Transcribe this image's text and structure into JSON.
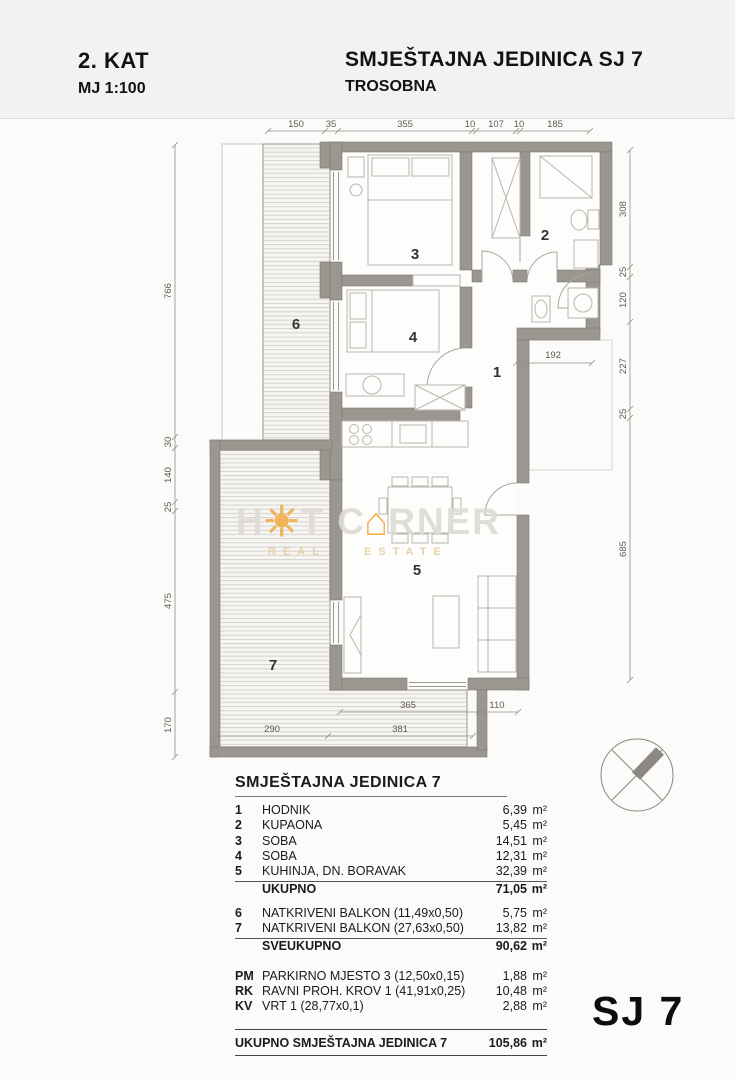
{
  "header": {
    "floor": "2. KAT",
    "scale": "MJ 1:100",
    "title": "SMJEŠTAJNA JEDINICA SJ 7",
    "subtitle": "TROSOBNA"
  },
  "plan": {
    "dims_top": [
      "150",
      "35",
      "355",
      "10",
      "107",
      "10",
      "185"
    ],
    "dims_left": [
      "766",
      "30",
      "140",
      "25",
      "475",
      "170"
    ],
    "dims_right": [
      "308",
      "25",
      "120",
      "227",
      "25",
      "685"
    ],
    "dims_bottom_row1": [
      "365",
      "110"
    ],
    "dims_bottom_row2": [
      "290",
      "381"
    ],
    "dim_interior": "192",
    "room_labels": [
      "1",
      "2",
      "3",
      "4",
      "5",
      "6",
      "7"
    ]
  },
  "watermark": {
    "part1": "H",
    "sun": "☀",
    "part2": "T C",
    "house": "⌂",
    "part3": "RNER",
    "tagline_left": "REAL",
    "tagline_right": "ESTATE"
  },
  "legend": {
    "title": "SMJEŠTAJNA JEDINICA 7",
    "rows": [
      {
        "no": "1",
        "name": "HODNIK",
        "area": "6,39",
        "unit": "m²"
      },
      {
        "no": "2",
        "name": "KUPAONA",
        "area": "5,45",
        "unit": "m²"
      },
      {
        "no": "3",
        "name": "SOBA",
        "area": "14,51",
        "unit": "m²"
      },
      {
        "no": "4",
        "name": "SOBA",
        "area": "12,31",
        "unit": "m²"
      },
      {
        "no": "5",
        "name": "KUHINJA, DN. BORAVAK",
        "area": "32,39",
        "unit": "m²"
      }
    ],
    "total1": {
      "label": "UKUPNO",
      "area": "71,05",
      "unit": "m²"
    },
    "rows2": [
      {
        "no": "6",
        "name": "NATKRIVENI BALKON (11,49x0,50)",
        "area": "5,75",
        "unit": "m²"
      },
      {
        "no": "7",
        "name": "NATKRIVENI BALKON (27,63x0,50)",
        "area": "13,82",
        "unit": "m²"
      }
    ],
    "total2": {
      "label": "SVEUKUPNO",
      "area": "90,62",
      "unit": "m²"
    },
    "rows3": [
      {
        "no": "PM",
        "name": "PARKIRNO MJESTO 3 (12,50x0,15)",
        "area": "1,88",
        "unit": "m²"
      },
      {
        "no": "RK",
        "name": "RAVNI PROH. KROV 1 (41,91x0,25)",
        "area": "10,48",
        "unit": "m²"
      },
      {
        "no": "KV",
        "name": "VRT 1 (28,77x0,1)",
        "area": "2,88",
        "unit": "m²"
      }
    ],
    "grand_total": {
      "label": "UKUPNO SMJEŠTAJNA JEDINICA 7",
      "area": "105,86",
      "unit": "m²"
    }
  },
  "unit_label": "SJ 7",
  "colors": {
    "wall": "#9b968f",
    "wall_edge": "#7d7872",
    "hatch_line": "#d6d3ce",
    "dim_text": "#5f5b56",
    "watermark_orange": "#f2ae4a",
    "paper": "#fbfbf9"
  }
}
